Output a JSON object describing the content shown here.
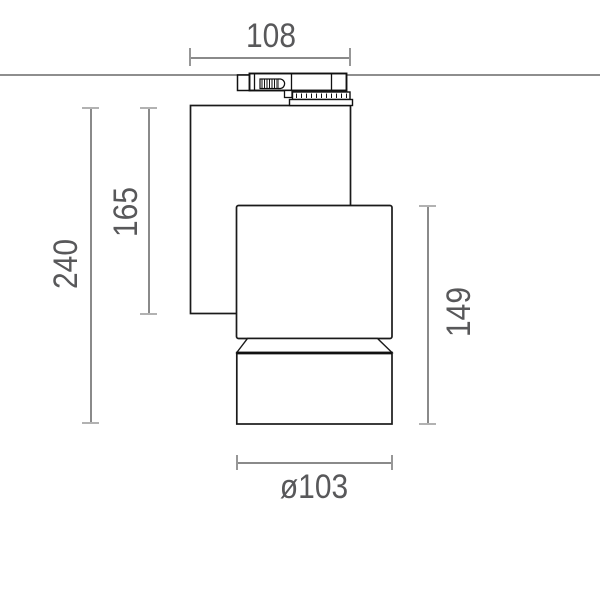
{
  "drawing": {
    "type": "technical-dimension-drawing",
    "fixture": "track-mounted spotlight, side view",
    "dimensions": {
      "track_adapter_width": "108",
      "overall_height": "240",
      "housing_height": "165",
      "head_height": "149",
      "barrel_diameter": "ø103"
    },
    "colors": {
      "background": "#ffffff",
      "outline": "#1a1a1a",
      "ceiling_line": "#8e8e8e",
      "dimension_line": "#8a8a8a",
      "dimension_tick": "#b2b2b2",
      "dimension_text": "#58585a"
    }
  }
}
